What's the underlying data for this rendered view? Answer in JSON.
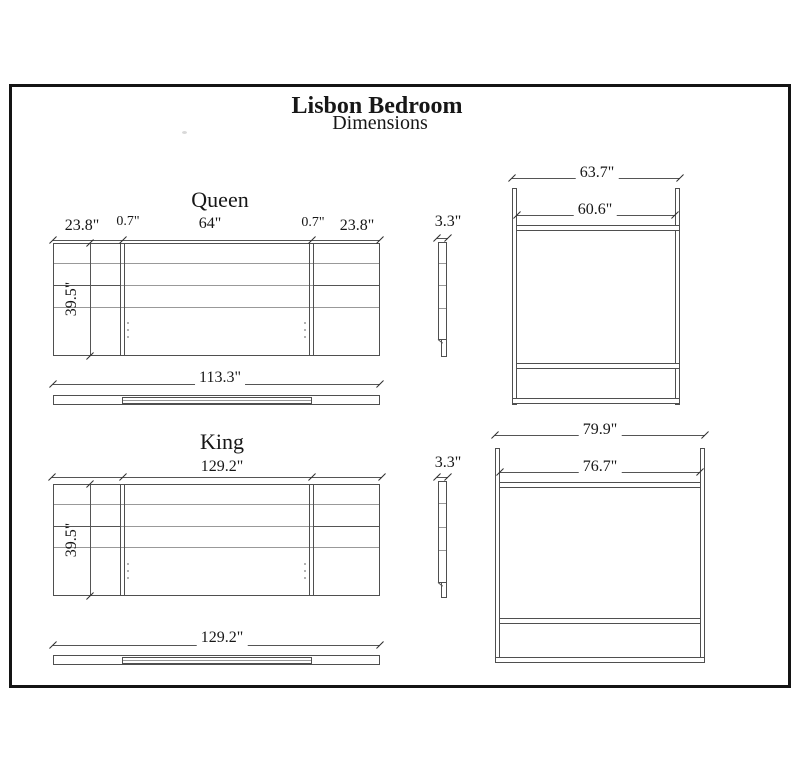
{
  "page_title": {
    "line1": "Lisbon Bedroom",
    "line2": "Dimensions"
  },
  "queen": {
    "section_label": "Queen",
    "headboard": {
      "left_panel_width": "23.8\"",
      "left_gap": "0.7\"",
      "center_width": "64\"",
      "right_gap": "0.7\"",
      "right_panel_width": "23.8\"",
      "height": "39.5\"",
      "side_thickness": "3.3\"",
      "rail_length": "113.3\""
    },
    "frame": {
      "outer_width": "63.7\"",
      "inner_width": "60.6\""
    }
  },
  "king": {
    "section_label": "King",
    "headboard": {
      "total_width": "129.2\"",
      "height": "39.5\"",
      "side_thickness": "3.3\"",
      "rail_length": "129.2\""
    },
    "frame": {
      "outer_width": "79.9\"",
      "inner_width": "76.7\""
    }
  },
  "colors": {
    "line": "#4f4f4f",
    "light_line": "#999999",
    "text": "#171717",
    "border": "#141414",
    "background": "#ffffff"
  }
}
